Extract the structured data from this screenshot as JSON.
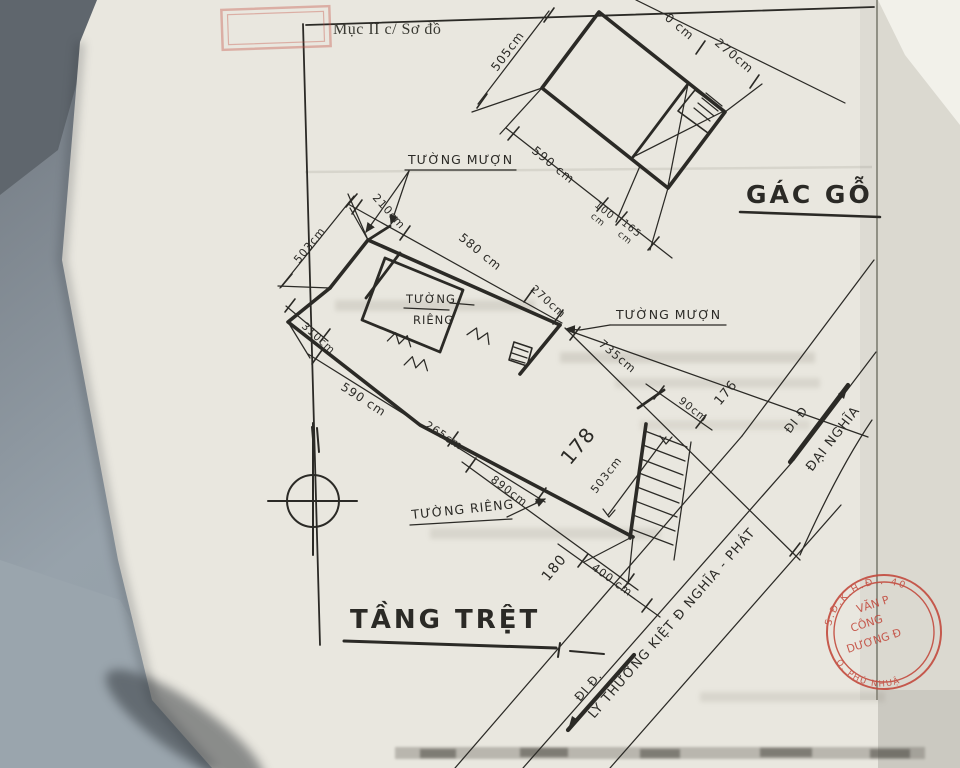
{
  "header": {
    "section_label": "Mục II c/ Sơ đồ"
  },
  "titles": {
    "attic": "GÁC GỖ",
    "ground": "TẦNG TRỆT"
  },
  "attic": {
    "dim_left": "505cm",
    "dim_top_fragment": "0 cm",
    "dim_top_right": "270cm",
    "dim_bottom_1": "590 cm",
    "dim_bottom_2": {
      "value": "100",
      "unit": "cm"
    },
    "dim_bottom_3": {
      "value": "165",
      "unit": "cm"
    }
  },
  "ground": {
    "wall_labels": {
      "borrowed_left": "TƯỜNG MƯỢN",
      "borrowed_right": "TƯỜNG MƯỢN",
      "private_room_line1": "TƯỜNG",
      "private_room_line2": "RIÊNG",
      "private_bottom": "TƯỜNG RIÊNG"
    },
    "dims": {
      "top_1": "210cm",
      "top_2": "580 cm",
      "top_3": "270cm",
      "left": "503cm",
      "west": "310cm",
      "bottom_1": "590 cm",
      "bottom_2": "265cm",
      "bottom_3": "890cm",
      "boundary_right": "735cm",
      "width_mid": "503cm",
      "end_right": "90cm",
      "frontage": "400 cm"
    },
    "lot_numbers": {
      "main": "178",
      "right": "176",
      "bottom": "180"
    }
  },
  "streets": {
    "street_1": {
      "name": "LÝ THƯỜNG KIỆT  Đ NGHĨA - PHÁT",
      "direction": "ĐI Đ."
    },
    "street_2": {
      "name": "ĐẠI NGHĨA",
      "direction": "ĐI Đ"
    }
  },
  "stamp": {
    "rim_top": "S.Đ.K.H.Đ . 402",
    "rim_bottom": "Q. PHÚ NHUẬN",
    "line1": "VĂN P",
    "line2": "CÔNG",
    "line3": "DƯƠNG Đ"
  },
  "colors": {
    "ink": "#2b2a26",
    "paper": "#e9e7df",
    "stamp_red": "#c2473a",
    "folder": "#8b959d"
  }
}
